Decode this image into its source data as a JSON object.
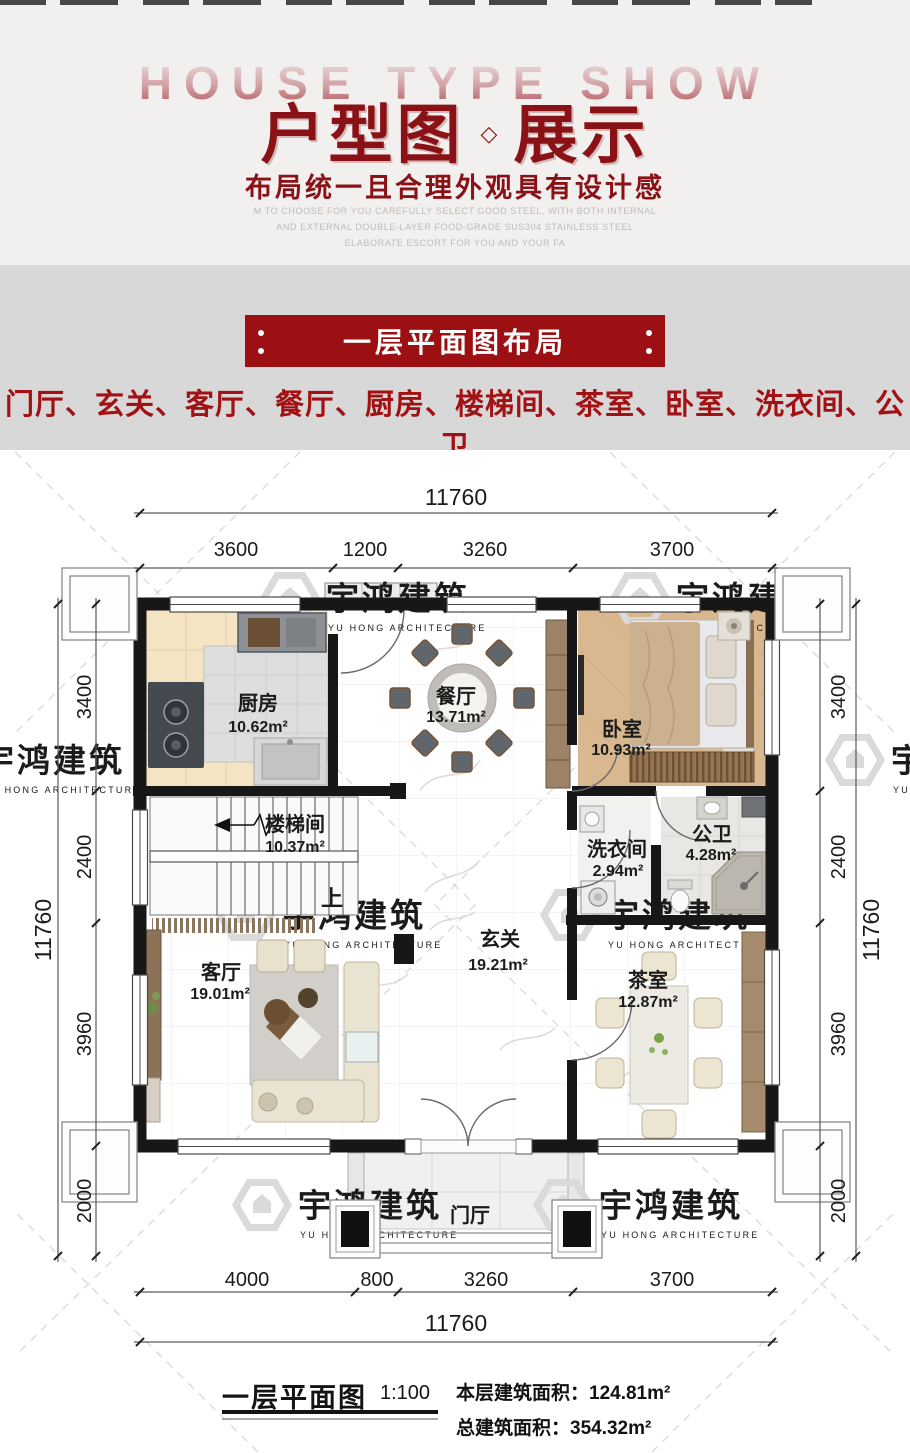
{
  "header": {
    "bg_title": "HOUSE TYPE SHOW",
    "title_left": "户型图",
    "title_diamond": "◇",
    "title_right": "展示",
    "subtitle": "布局统一且合理外观具有设计感",
    "en_lines": [
      "M TO CHOOSE FOR YOU CAREFULLY SELECT GOOD STEEL, WITH BOTH INTERNAL",
      "AND EXTERNAL DOUBLE-LAYER FOOD-GRADE SUS304 STAINLESS STEEL",
      "ELABORATE ESCORT FOR YOU AND YOUR FA"
    ]
  },
  "section": {
    "banner": "一层平面图布局",
    "room_list": "门厅、玄关、客厅、餐厅、厨房、楼梯间、茶室、卧室、洗衣间、公卫"
  },
  "plan": {
    "rooms": {
      "kitchen": {
        "name": "厨房",
        "area": "10.62m²"
      },
      "dining": {
        "name": "餐厅",
        "area": "13.71m²"
      },
      "bedroom": {
        "name": "卧室",
        "area": "10.93m²"
      },
      "stair": {
        "name": "楼梯间",
        "area": "10.37m²"
      },
      "laundry": {
        "name": "洗衣间",
        "area": "2.94m²"
      },
      "bath": {
        "name": "公卫",
        "area": "4.28m²"
      },
      "foyer": {
        "name": "玄关",
        "area": "19.21m²"
      },
      "living": {
        "name": "客厅",
        "area": "19.01m²"
      },
      "tea": {
        "name": "茶室",
        "area": "12.87m²"
      },
      "porch": {
        "name": "门厅"
      }
    },
    "up_label": "上",
    "dims": {
      "top": {
        "total": "11760",
        "segments": [
          "3600",
          "1200",
          "3260",
          "3700"
        ]
      },
      "bottom": {
        "total": "11760",
        "segments": [
          "4000",
          "800",
          "3260",
          "3700"
        ]
      },
      "left": {
        "total": "11760",
        "segments": [
          "3400",
          "2400",
          "3960",
          "2000"
        ]
      },
      "right": {
        "total": "11760",
        "segments": [
          "3400",
          "2400",
          "3960",
          "2000"
        ]
      }
    },
    "watermark": {
      "cn": "宇鸿建筑",
      "en": "YU HONG ARCHITECTURE"
    }
  },
  "caption": {
    "title": "一层平面图",
    "scale": "1:100",
    "floor_area": "本层建筑面积：124.81m²",
    "total_area": "总建筑面积：354.32m²"
  },
  "colors": {
    "accent_red": "#9c1013",
    "title_red": "#8a1216",
    "list_red": "#a21113"
  }
}
